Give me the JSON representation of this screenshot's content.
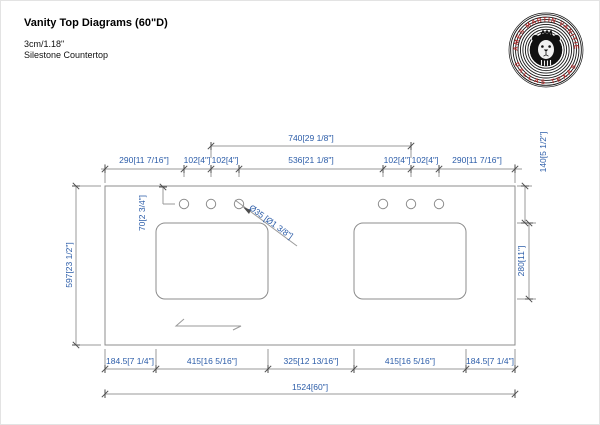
{
  "header": {
    "title": "Vanity Top Diagrams (60\"D)",
    "subtitle1": "3cm/1.18\"",
    "subtitle2": "Silestone Countertop"
  },
  "logo": {
    "arc_top": "JAMES MARTIN VANITIES",
    "arc_bottom": "DALLAS TEXAS",
    "text_color": "#b52a2a",
    "ring_color": "#151515"
  },
  "dims": {
    "color": "#2b5ca8",
    "top_span": "740[29 1/8\"]",
    "top_row": [
      "290[11 7/16\"]",
      "102[4\"]",
      "102[4\"]",
      "536[21 1/8\"]",
      "102[4\"]",
      "102[4\"]",
      "290[11 7/16\"]"
    ],
    "bottom_row": [
      "184.5[7 1/4\"]",
      "415[16 5/16\"]",
      "325[12 13/16\"]",
      "415[16 5/16\"]",
      "184.5[7 1/4\"]"
    ],
    "bottom_total": "1524[60\"]",
    "left_depth": "597[23 1/2\"]",
    "faucet_offset": "70[2 3/4\"]",
    "cutout_depth": "280[11\"]",
    "back_to_cutout": "140[5 1/2\"]",
    "hole_diameter": "Ø35 [Ø1 3/8\"]"
  }
}
